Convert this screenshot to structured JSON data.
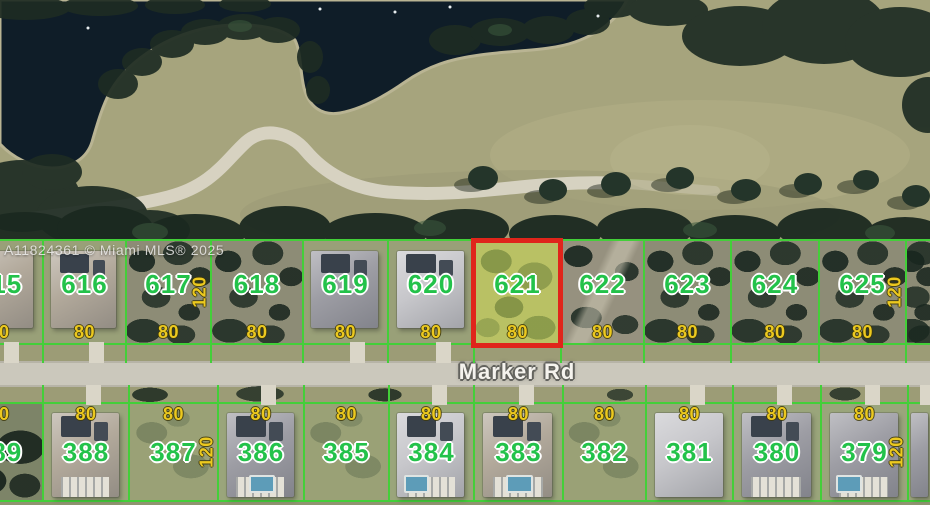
{
  "watermark": {
    "text": "A11824361 © Miami MLS® 2025"
  },
  "road": {
    "label": "Marker Rd"
  },
  "highlight": {
    "lot_number": "621",
    "border_color": "#e0251b"
  },
  "colors": {
    "parcel_line": "#43cf39",
    "lot_number_text": "#23c24a",
    "dimension_text": "#ecc91f",
    "highlight_border": "#e0251b",
    "highlight_fill": "#b9c164",
    "road_pavement": "#cbc8bc",
    "water": "#0f1d28",
    "fairway": "#a6a47d",
    "road_label_text": "#f5f3ee"
  },
  "rows": {
    "top": {
      "lots": [
        {
          "number": "615",
          "x": -46,
          "w": 88,
          "frontage": "80",
          "house": {
            "tone": "tan"
          }
        },
        {
          "number": "616",
          "x": 42,
          "w": 83,
          "frontage": "80",
          "house": {
            "tone": "tan",
            "panels": true
          }
        },
        {
          "number": "617",
          "x": 125,
          "w": 85,
          "frontage": "80",
          "depth": "120",
          "vacant": "scrub"
        },
        {
          "number": "618",
          "x": 210,
          "w": 92,
          "frontage": "80",
          "vacant": "scrub"
        },
        {
          "number": "619",
          "x": 302,
          "w": 85,
          "frontage": "80",
          "house": {
            "tone": "gray",
            "panels": true
          }
        },
        {
          "number": "620",
          "x": 387,
          "w": 86,
          "frontage": "80",
          "house": {
            "tone": "light",
            "panels": true
          }
        },
        {
          "number": "621",
          "x": 473,
          "w": 87,
          "frontage": "80",
          "highlighted": true
        },
        {
          "number": "622",
          "x": 560,
          "w": 83,
          "frontage": "80",
          "vacant": "sand"
        },
        {
          "number": "623",
          "x": 643,
          "w": 87,
          "frontage": "80",
          "vacant": "scrub"
        },
        {
          "number": "624",
          "x": 730,
          "w": 88,
          "frontage": "80",
          "vacant": "scrub"
        },
        {
          "number": "625",
          "x": 818,
          "w": 87,
          "frontage": "80",
          "depth": "120",
          "vacant": "scrub"
        },
        {
          "number": "",
          "x": 905,
          "w": 26,
          "vacant": "scrub"
        }
      ]
    },
    "bottom": {
      "lots": [
        {
          "number": "389",
          "x": -46,
          "w": 88,
          "frontage": "80",
          "vacant": "trees"
        },
        {
          "number": "388",
          "x": 42,
          "w": 86,
          "frontage": "80",
          "house": {
            "tone": "tan",
            "panels": true,
            "lanai": true
          }
        },
        {
          "number": "387",
          "x": 128,
          "w": 89,
          "frontage": "80",
          "depth": "120",
          "vacant": "lawn"
        },
        {
          "number": "386",
          "x": 217,
          "w": 86,
          "frontage": "80",
          "house": {
            "tone": "gray",
            "panels": true,
            "lanai": true,
            "pool": "center"
          }
        },
        {
          "number": "385",
          "x": 303,
          "w": 85,
          "frontage": "80",
          "vacant": "lawn"
        },
        {
          "number": "384",
          "x": 388,
          "w": 85,
          "frontage": "80",
          "house": {
            "tone": "light",
            "panels": true,
            "lanai": true,
            "pool": "left"
          }
        },
        {
          "number": "383",
          "x": 473,
          "w": 89,
          "frontage": "80",
          "house": {
            "tone": "tan",
            "panels": true,
            "lanai": true,
            "pool": "center"
          }
        },
        {
          "number": "382",
          "x": 562,
          "w": 83,
          "frontage": "80",
          "vacant": "lawn"
        },
        {
          "number": "381",
          "x": 645,
          "w": 87,
          "frontage": "80",
          "house": {
            "tone": "light"
          }
        },
        {
          "number": "380",
          "x": 732,
          "w": 88,
          "frontage": "80",
          "house": {
            "tone": "gray",
            "panels": true,
            "lanai": true
          }
        },
        {
          "number": "379",
          "x": 820,
          "w": 87,
          "frontage": "80",
          "depth": "120",
          "house": {
            "tone": "gray",
            "lanai": true,
            "pool": "left"
          }
        },
        {
          "number": "",
          "x": 907,
          "w": 23,
          "house": {
            "tone": "gray"
          }
        }
      ]
    }
  }
}
